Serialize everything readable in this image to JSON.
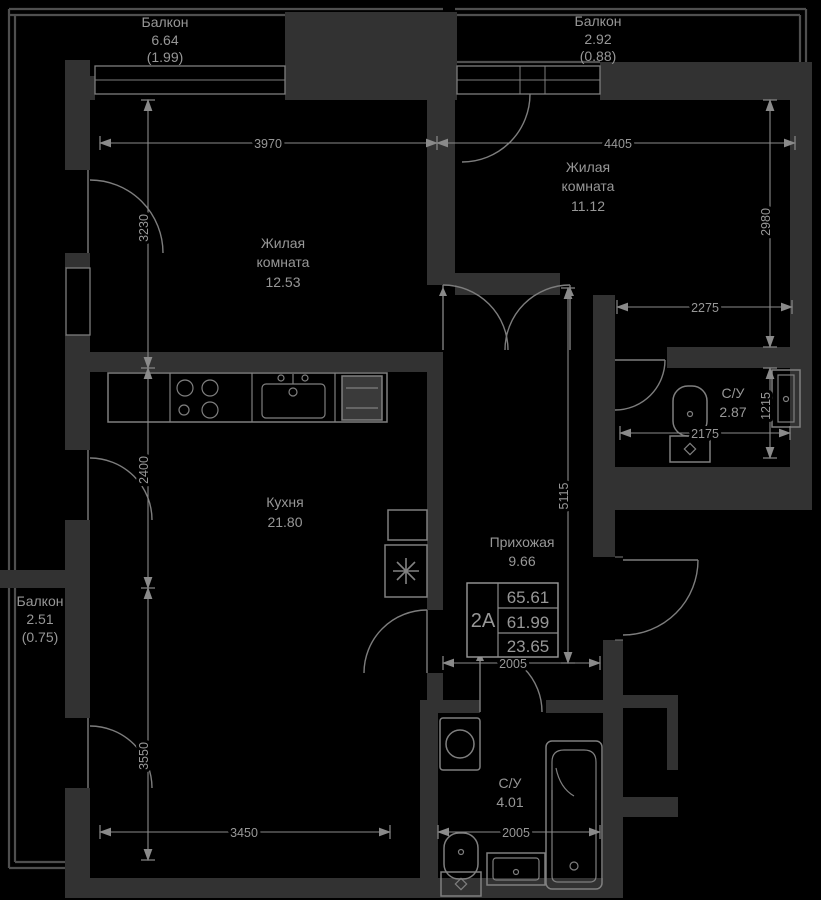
{
  "plan_title": "Floor plan unit 2A",
  "labels": {
    "balcony_tl": {
      "name": "Балкон",
      "area": "6.64",
      "coef": "(1.99)"
    },
    "balcony_tr": {
      "name": "Балкон",
      "area": "2.92",
      "coef": "(0.88)"
    },
    "balcony_left": {
      "name": "Балкон",
      "area": "2.51",
      "coef": "(0.75)"
    },
    "room1": {
      "name_line1": "Жилая",
      "name_line2": "комната",
      "area": "12.53"
    },
    "room2": {
      "name_line1": "Жилая",
      "name_line2": "комната",
      "area": "11.12"
    },
    "kitchen": {
      "name": "Кухня",
      "area": "21.80"
    },
    "hallway": {
      "name": "Прихожая",
      "area": "9.66"
    },
    "bath_small": {
      "name": "С/У",
      "area": "2.87"
    },
    "bath_big": {
      "name": "С/У",
      "area": "4.01"
    }
  },
  "stamp": {
    "unit": "2А",
    "total_area": "65.61",
    "area_no_balcony": "61.99",
    "living_area": "23.65"
  },
  "dims": {
    "room1_width": "3970",
    "room2_width": "4405",
    "room1_height": "3230",
    "room2_height": "2980",
    "room2_ext_width": "2275",
    "bath_small_width": "2175",
    "bath_small_height": "1215",
    "kitchen_height": "2400",
    "hall_height": "5115",
    "hall_width": "2005",
    "bath_big_width": "2005",
    "kitchen_lower_height": "3550",
    "kitchen_width": "3450"
  },
  "colors": {
    "background": "#000000",
    "walls": "#323232",
    "lines": "#7d7d7d",
    "dimensions": "#8a8a8a",
    "text": "#979797"
  }
}
